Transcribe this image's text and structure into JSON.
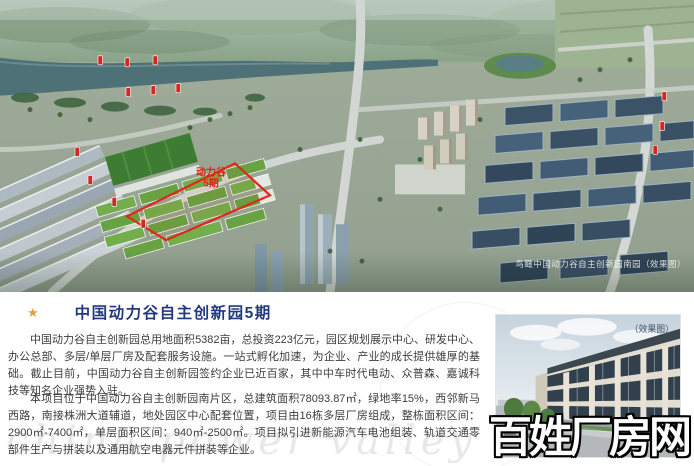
{
  "hero": {
    "caption": "鸟瞰中国动力谷自主创新园南园（效果图）",
    "area_label": {
      "line1": "动力谷",
      "line2": "5期"
    }
  },
  "article": {
    "star": "★",
    "title": "中国动力谷自主创新园5期",
    "paragraph1": "中国动力谷自主创新园总用地面积5382亩，总投资223亿元，园区规划展示中心、研发中心、办公总部、多层/单层厂房及配套服务设施。一站式孵化加速，为企业、产业的成长提供雄厚的基础。截止目前，中国动力谷自主创新园签约企业已近百家，其中中车时代电动、众普森、嘉诚科技等知名企业强势入驻。",
    "paragraph2": "本项目位于中国动力谷自主创新园南片区，总建筑面积78093.87㎡，绿地率15%，西邻新马西路，南接株洲大道辅道，地处园区中心配套位置，项目由16栋多层厂房组成，整栋面积区间：2900㎡-7400㎡，单层面积区间：940㎡-2500㎡。项目拟引进新能源汽车电池组装、轨道交通零部件生产与拼装以及通用航空电器元件拼装等企业。"
  },
  "photo": {
    "label": "（效果图）"
  },
  "watermarks": {
    "site": "百姓厂房网",
    "script": "china power valley"
  },
  "colors": {
    "title_blue": "#21397f",
    "star_gold": "#e2a33c",
    "marker_red": "#d3281e",
    "outline_red": "#e02818",
    "caption_white": "#ffffff"
  }
}
